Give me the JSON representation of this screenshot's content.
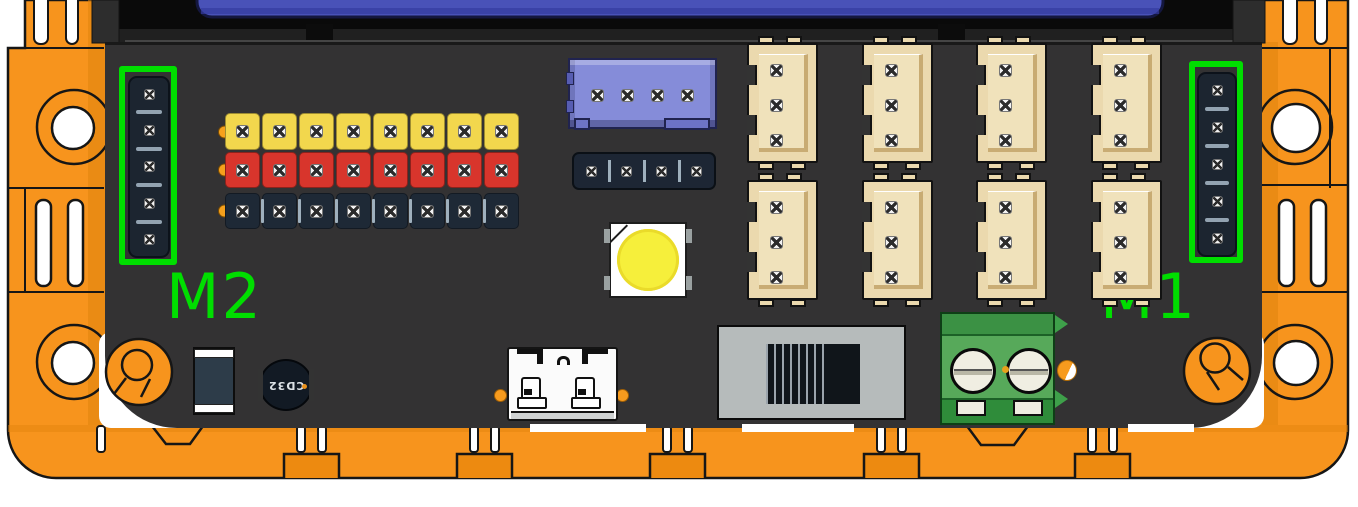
{
  "scene": {
    "description": "3D render of a robot controller board mounted in an orange brick chassis, with the two motor ports highlighted in green",
    "background_color": "#ffffff",
    "frame_color": "#F7941D",
    "pcb_color": "#333333",
    "highlight_color": "#00DE00",
    "blue_insert_color": "#4952B8"
  },
  "annotations": {
    "m2": {
      "text": "M2"
    },
    "m1": {
      "text": "M1"
    }
  },
  "components": {
    "m2_port": {
      "pin_count": 5
    },
    "m1_port": {
      "pin_count": 5
    },
    "gpio_header": {
      "pin_columns": 8,
      "rows": [
        {
          "name": "signal",
          "color": "#F2D74D"
        },
        {
          "name": "power",
          "color": "#D8352C"
        },
        {
          "name": "ground",
          "color": "#1E2936"
        }
      ]
    },
    "i2c_connector": {
      "pin_count": 4,
      "color": "#858CD9"
    },
    "aux_header": {
      "pin_count": 4
    },
    "servo_ports": {
      "rows": 2,
      "cols": 4,
      "pins_each": 3,
      "color": "#EBD9AE"
    },
    "rgb_led": {
      "color": "#F6EF3B"
    },
    "buzzer": {
      "label": "CD32"
    },
    "power_terminal": {
      "screws": 2
    }
  }
}
